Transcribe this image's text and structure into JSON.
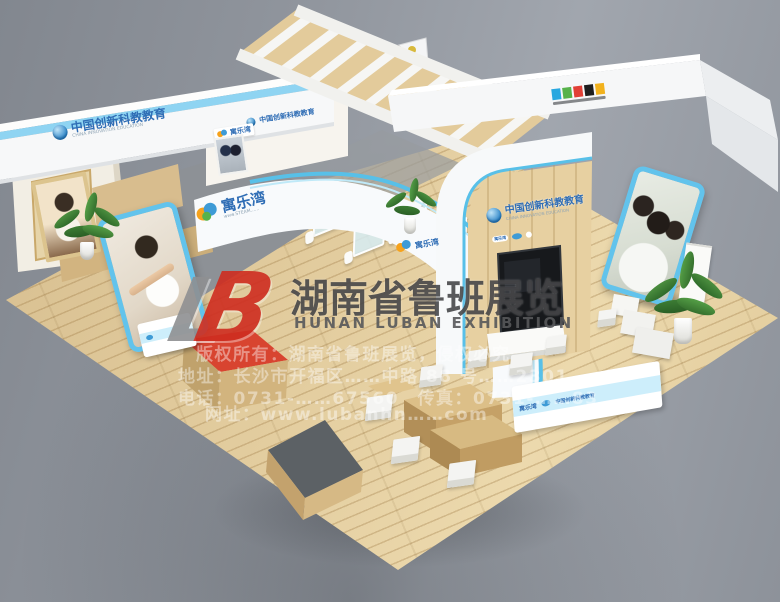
{
  "watermark": {
    "logo_l": "L",
    "logo_b": "B",
    "title_cn": "湖南省鲁班展览",
    "title_en": "HUNAN LUBAN EXHIBITION",
    "line1": "版权所有：湖南省鲁班展览，侵权必究",
    "line2": "地址：长沙市开福区……中路 88 号……2301",
    "line3": "电话：0731-……67560　传真：0731-……83",
    "line4": "网址：www.lubanhn……com"
  },
  "booth": {
    "brand_name": "寓乐湾",
    "brand_url": "www.STEAM……",
    "slogan_cn": "中国创新科教教育",
    "slogan_sub": "CHINA INNOVATION EDUCATION"
  },
  "colors": {
    "accent_blue": "#5fc3ea",
    "brand_blue": "#2f6db5",
    "wood": "#e2cb9c",
    "red_platform": "#d84430",
    "watermark_red": "#cf2d20"
  }
}
